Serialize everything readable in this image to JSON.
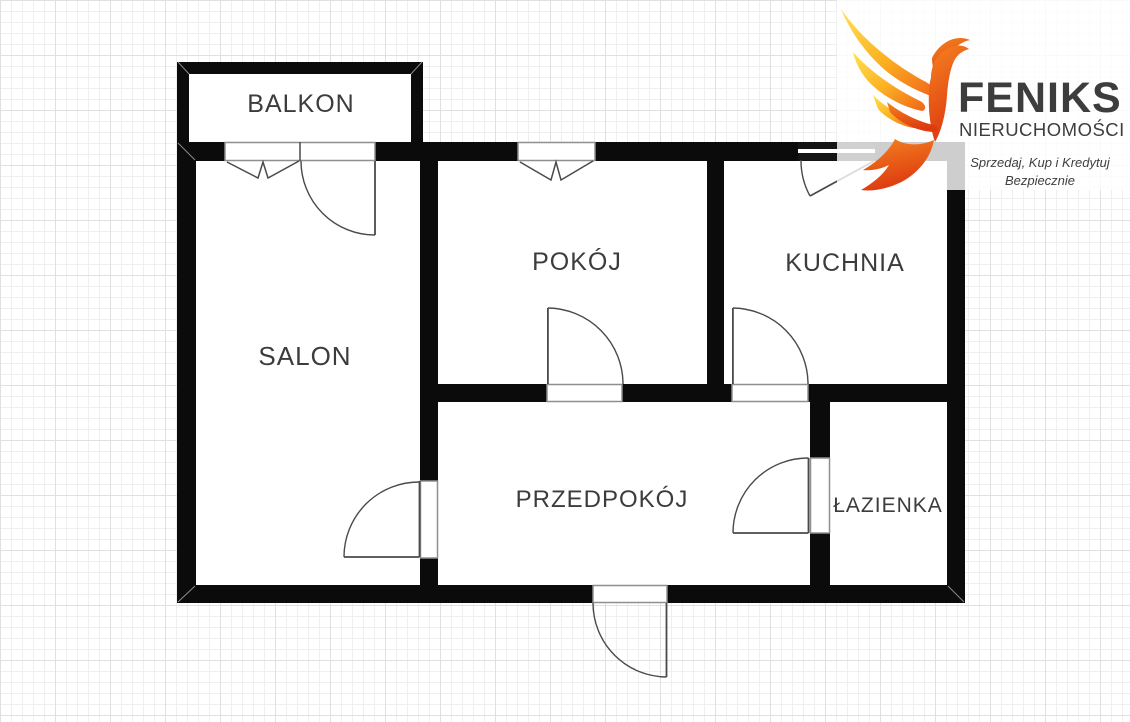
{
  "floor_plan": {
    "rooms": [
      {
        "id": "balkon",
        "label": "BALKON"
      },
      {
        "id": "salon",
        "label": "SALON"
      },
      {
        "id": "pokoj",
        "label": "POKÓJ"
      },
      {
        "id": "kuchnia",
        "label": "KUCHNIA"
      },
      {
        "id": "przedpokoj",
        "label": "PRZEDPOKÓJ"
      },
      {
        "id": "lazienka",
        "label": "ŁAZIENKA"
      }
    ],
    "colors": {
      "wall": "#0b0b0b",
      "symbol_line": "#4a4a4a",
      "label_text": "#3c3c3c",
      "grid_line": "#e9e9e9"
    }
  },
  "logo": {
    "icon": "phoenix-flame-bird",
    "brand": "FENIKS",
    "subtitle": "NIERUCHOMOŚCI",
    "tagline_line1": "Sprzedaj, Kup i Kredytuj",
    "tagline_line2": "Bezpiecznie",
    "colors": {
      "text": "#3d3d3d",
      "flame_yellow": "#FFE14F",
      "flame_orange": "#F7941D",
      "flame_red": "#DD3A10"
    }
  }
}
